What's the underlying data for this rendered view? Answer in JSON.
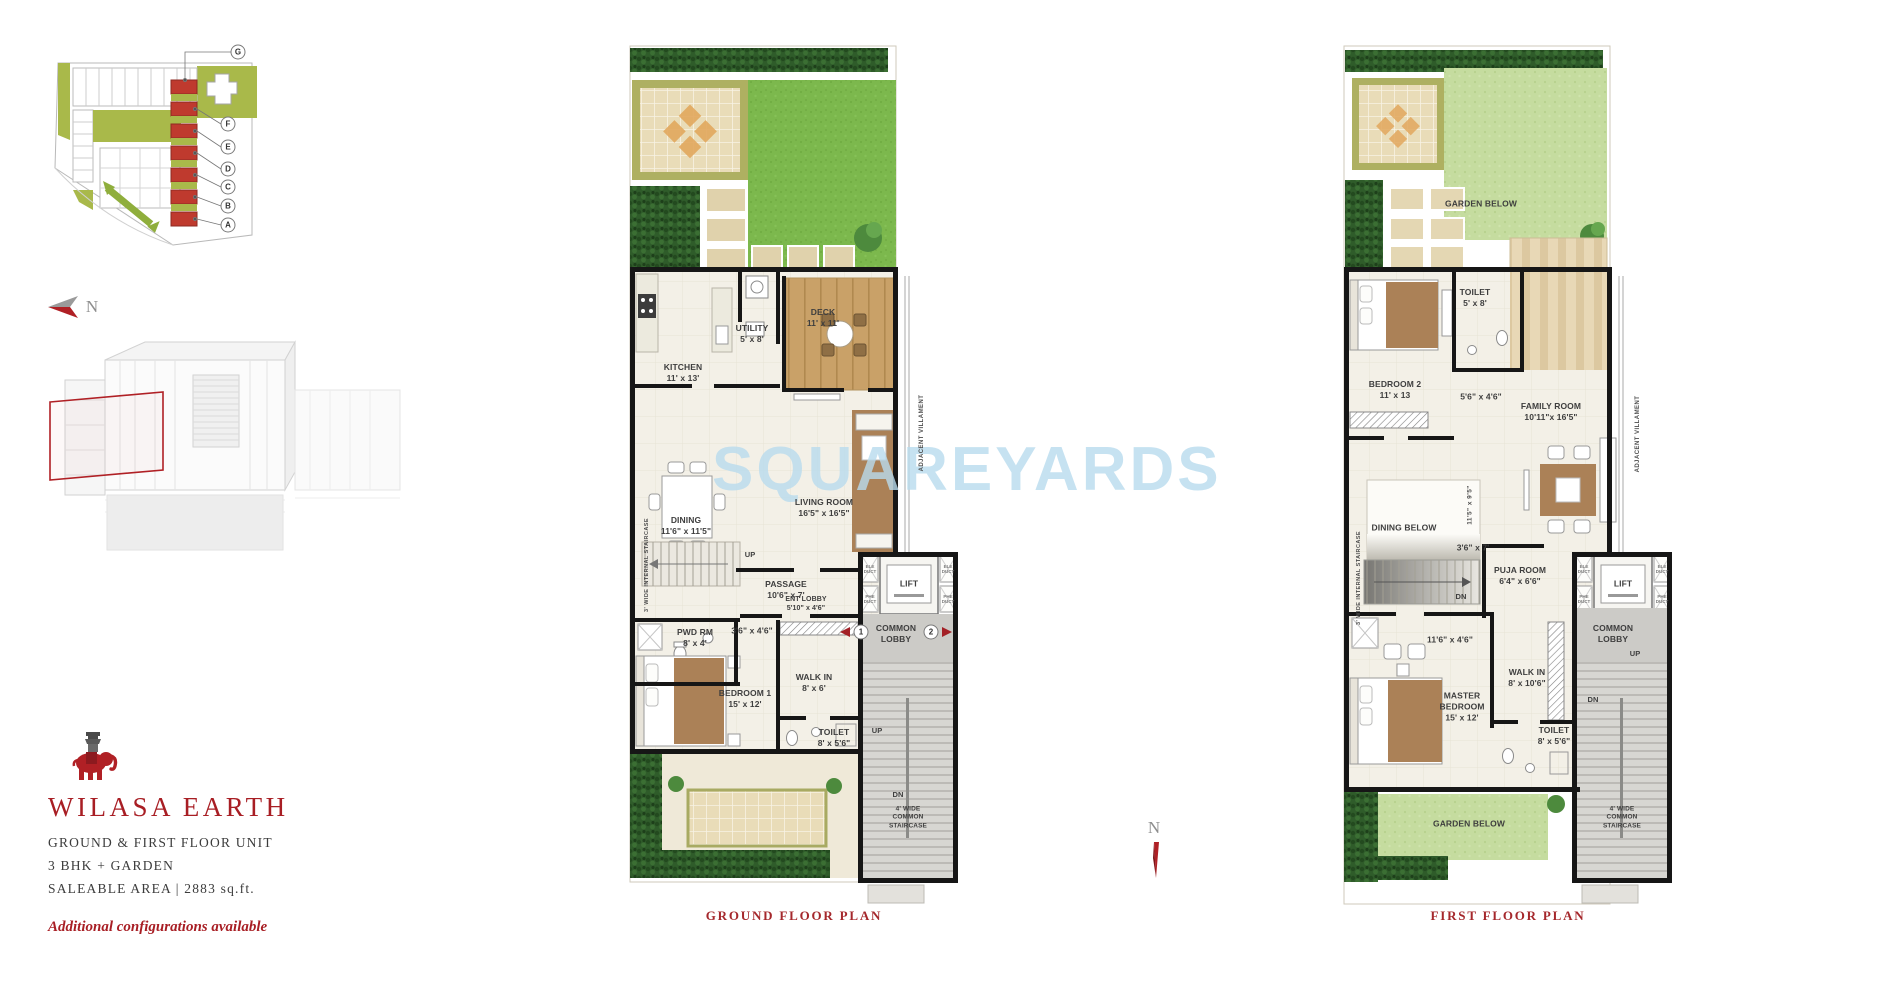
{
  "branding": {
    "project_name": "WILASA EARTH",
    "unit_type": "GROUND & FIRST FLOOR UNIT",
    "configuration": "3 BHK + GARDEN",
    "saleable_area": "SALEABLE AREA | 2883 sq.ft.",
    "note": "Additional configurations available"
  },
  "watermark": "SQUAREYARDS",
  "north_label": "N",
  "site_map": {
    "unit_markers": [
      "G",
      "F",
      "E",
      "D",
      "C",
      "B",
      "A"
    ]
  },
  "duct_labels": {
    "ele": "ELE\nDUCT",
    "phe": "PHE\nDUCT"
  },
  "ground_floor": {
    "caption": "GROUND FLOOR PLAN",
    "adjacent_label": "ADJACENT VILLAMENT",
    "internal_stair_label": "3' WIDE INTERNAL STAIRCASE",
    "common_stair_label": "4' WIDE COMMON\nSTAIRCASE",
    "up_label": "UP",
    "dn_label": "DN",
    "entry_markers": [
      "1",
      "2"
    ],
    "rooms": [
      {
        "name": "UTILITY",
        "dims": "5' x 8'"
      },
      {
        "name": "KITCHEN",
        "dims": "11' x 13'"
      },
      {
        "name": "DECK",
        "dims": "11' x 11'"
      },
      {
        "name": "LIVING ROOM",
        "dims": "16'5\" x 16'5\""
      },
      {
        "name": "DINING",
        "dims": "11'6\" x 11'5\""
      },
      {
        "name": "PASSAGE",
        "dims": "10'6\" x 7'"
      },
      {
        "name": "ENT LOBBY",
        "dims": "5'10\" x 4'6\""
      },
      {
        "name": "LIFT",
        "dims": ""
      },
      {
        "name": "COMMON\nLOBBY",
        "dims": ""
      },
      {
        "name": "PWD RM",
        "dims": "8' x 4'"
      },
      {
        "name": "",
        "dims": "3'6\" x 4'6\""
      },
      {
        "name": "BEDROOM 1",
        "dims": "15' x 12'"
      },
      {
        "name": "WALK IN",
        "dims": "8' x 6'"
      },
      {
        "name": "TOILET",
        "dims": "8' x 5'6\""
      }
    ]
  },
  "first_floor": {
    "caption": "FIRST FLOOR PLAN",
    "adjacent_label": "ADJACENT VILLAMENT",
    "internal_stair_label": "3' WIDE INTERNAL STAIRCASE",
    "common_stair_label": "4' WIDE COMMON\nSTAIRCASE",
    "up_label": "UP",
    "dn_label": "DN",
    "rooms": [
      {
        "name": "GARDEN BELOW",
        "dims": ""
      },
      {
        "name": "TOILET",
        "dims": "5' x 8'"
      },
      {
        "name": "BEDROOM 2",
        "dims": "11' x 13"
      },
      {
        "name": "",
        "dims": "5'6\" x 4'6\""
      },
      {
        "name": "FAMILY ROOM",
        "dims": "10'11\"x 16'5\""
      },
      {
        "name": "DINING BELOW",
        "dims": ""
      },
      {
        "name": "",
        "dims": "3'6\" x 7'"
      },
      {
        "name": "PUJA ROOM",
        "dims": "6'4\" x 6'6\""
      },
      {
        "name": "",
        "dims": "11'5\" x 9'5\""
      },
      {
        "name": "LIFT",
        "dims": ""
      },
      {
        "name": "",
        "dims": "11'6\" x 4'6\""
      },
      {
        "name": "COMMON\nLOBBY",
        "dims": ""
      },
      {
        "name": "WALK IN",
        "dims": "8' x 10'6\""
      },
      {
        "name": "MASTER\nBEDROOM",
        "dims": "15' x 12'"
      },
      {
        "name": "TOILET",
        "dims": "8' x 5'6\""
      },
      {
        "name": "GARDEN BELOW",
        "dims": ""
      }
    ]
  }
}
